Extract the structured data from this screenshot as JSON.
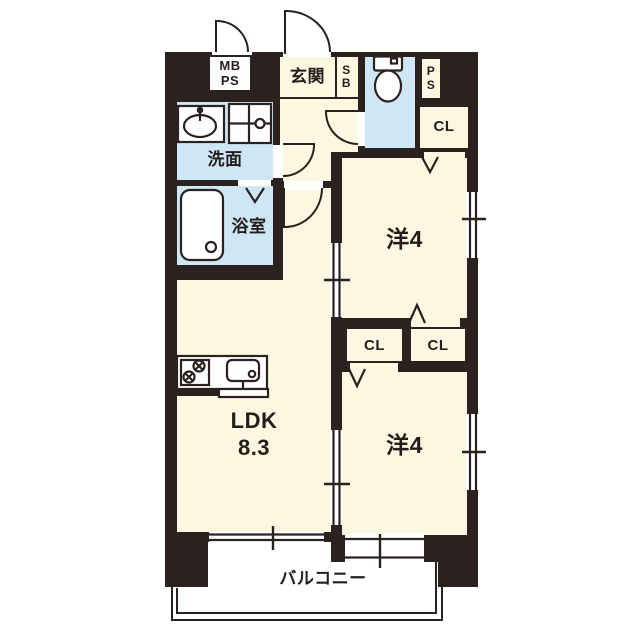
{
  "type": "apartment-floor-plan",
  "colors": {
    "wall": "#2b2220",
    "room_cream": "#fbf7e0",
    "wet_area_blue": "#cfe6f4",
    "background": "#ffffff"
  },
  "rooms": {
    "entrance": {
      "label": "玄関"
    },
    "shoe_box": {
      "label": "S\nB"
    },
    "meter_box": {
      "label": "MB\nPS"
    },
    "pipe_space": {
      "label": "P\nS"
    },
    "washroom": {
      "label": "洗面"
    },
    "bathroom": {
      "label": "浴室"
    },
    "living": {
      "label": "LDK\n8.3"
    },
    "western_room_top": {
      "label": "洋4"
    },
    "western_room_bottom": {
      "label": "洋4"
    },
    "closet_top_right": {
      "label": "CL"
    },
    "closet_mid_left": {
      "label": "CL"
    },
    "closet_mid_right": {
      "label": "CL"
    },
    "balcony": {
      "label": "バルコニー"
    }
  },
  "fixtures": [
    "toilet-icon",
    "sink-icon",
    "washing-machine-pan-icon",
    "bathtub-icon",
    "stove-icon",
    "kitchen-sink-icon"
  ]
}
